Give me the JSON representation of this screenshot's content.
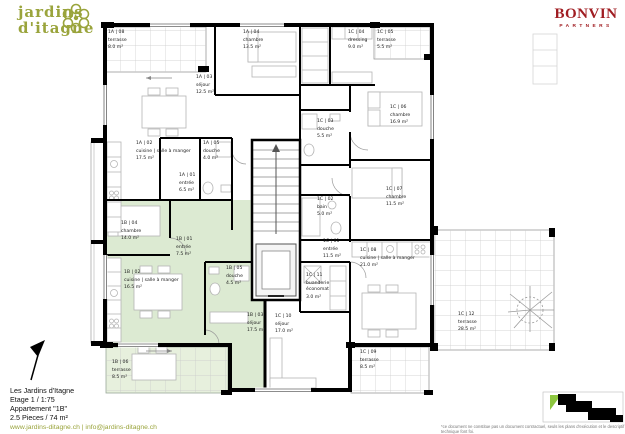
{
  "header": {
    "logo": {
      "icon": "flower-icon",
      "line1": "jardins",
      "line2": "d'itagne"
    },
    "brand": {
      "name": "BONVIN",
      "sub": "PARTNERS"
    }
  },
  "plan": {
    "highlighted_apartment": "1B",
    "rooms": [
      {
        "code": "1A | 08",
        "apartment": "1A",
        "lines": [
          "terrasse"
        ],
        "area": "8.0 m²"
      },
      {
        "code": "1A | 03",
        "apartment": "1A",
        "lines": [
          "séjour"
        ],
        "area": "12.5 m²"
      },
      {
        "code": "1A | 04",
        "apartment": "1A",
        "lines": [
          "chambre"
        ],
        "area": "13.5 m²"
      },
      {
        "code": "1A | 02",
        "apartment": "1A",
        "lines": [
          "cuisine | salle à manger"
        ],
        "area": "17.5 m²"
      },
      {
        "code": "1A | 05",
        "apartment": "1A",
        "lines": [
          "douche"
        ],
        "area": "4.0 m²"
      },
      {
        "code": "1A | 01",
        "apartment": "1A",
        "lines": [
          "entrée"
        ],
        "area": "6.5 m²"
      },
      {
        "code": "1B | 04",
        "apartment": "1B",
        "lines": [
          "chambre"
        ],
        "area": "14.0 m²"
      },
      {
        "code": "1B | 01",
        "apartment": "1B",
        "lines": [
          "entrée"
        ],
        "area": "7.5 m²"
      },
      {
        "code": "1B | 02",
        "apartment": "1B",
        "lines": [
          "cuisine | salle à manger"
        ],
        "area": "16.5 m²"
      },
      {
        "code": "1B | 05",
        "apartment": "1B",
        "lines": [
          "douche"
        ],
        "area": "4.5 m²"
      },
      {
        "code": "1B | 03",
        "apartment": "1B",
        "lines": [
          "séjour"
        ],
        "area": "17.5 m²"
      },
      {
        "code": "1B | 06",
        "apartment": "1B",
        "lines": [
          "terrasse"
        ],
        "area": "8.5 m²"
      },
      {
        "code": "1C | 04",
        "apartment": "1C",
        "lines": [
          "dressing"
        ],
        "area": "9.0 m²"
      },
      {
        "code": "1C | 05",
        "apartment": "1C",
        "lines": [
          "terrasse"
        ],
        "area": "5.5 m²"
      },
      {
        "code": "1C | 06",
        "apartment": "1C",
        "lines": [
          "chambre"
        ],
        "area": "16.9 m²"
      },
      {
        "code": "1C | 03",
        "apartment": "1C",
        "lines": [
          "douche"
        ],
        "area": "5.5 m²"
      },
      {
        "code": "1C | 02",
        "apartment": "1C",
        "lines": [
          "bain"
        ],
        "area": "5.0 m²"
      },
      {
        "code": "1C | 07",
        "apartment": "1C",
        "lines": [
          "chambre"
        ],
        "area": "11.5 m²"
      },
      {
        "code": "1C | 01",
        "apartment": "1C",
        "lines": [
          "entrée"
        ],
        "area": "11.5 m²"
      },
      {
        "code": "1C | 11",
        "apartment": "1C",
        "lines": [
          "buanderie",
          "économat"
        ],
        "area": "3.0 m²"
      },
      {
        "code": "1C | 08",
        "apartment": "1C",
        "lines": [
          "cuisine | salle à manger"
        ],
        "area": "21.0 m²"
      },
      {
        "code": "1C | 10",
        "apartment": "1C",
        "lines": [
          "séjour"
        ],
        "area": "17.0 m²"
      },
      {
        "code": "1C | 09",
        "apartment": "1C",
        "lines": [
          "terrasse"
        ],
        "area": "8.5 m²"
      },
      {
        "code": "1C | 12",
        "apartment": "1C",
        "lines": [
          "terrasse"
        ],
        "area": "28.5 m²"
      }
    ]
  },
  "footer": {
    "project": "Les Jardins d'Itagne",
    "stage": "Etage 1 / 1:75",
    "apartment": "Appartement \"1B\"",
    "size": "2.5 Pieces / 74 m²",
    "links": "www.jardins-ditagne.ch | info@jardins-ditagne.ch",
    "disclaimer": "*ce document ne constitue pas un document contractuel, seuls les plans d'exécution et le descriptif technique font foi."
  },
  "colors": {
    "highlight_green": "#dcead2",
    "terrace_green": "#e7f0dd",
    "logo_olive": "#9aa43c",
    "brand_red": "#a01d22",
    "wall_black": "#000000"
  }
}
